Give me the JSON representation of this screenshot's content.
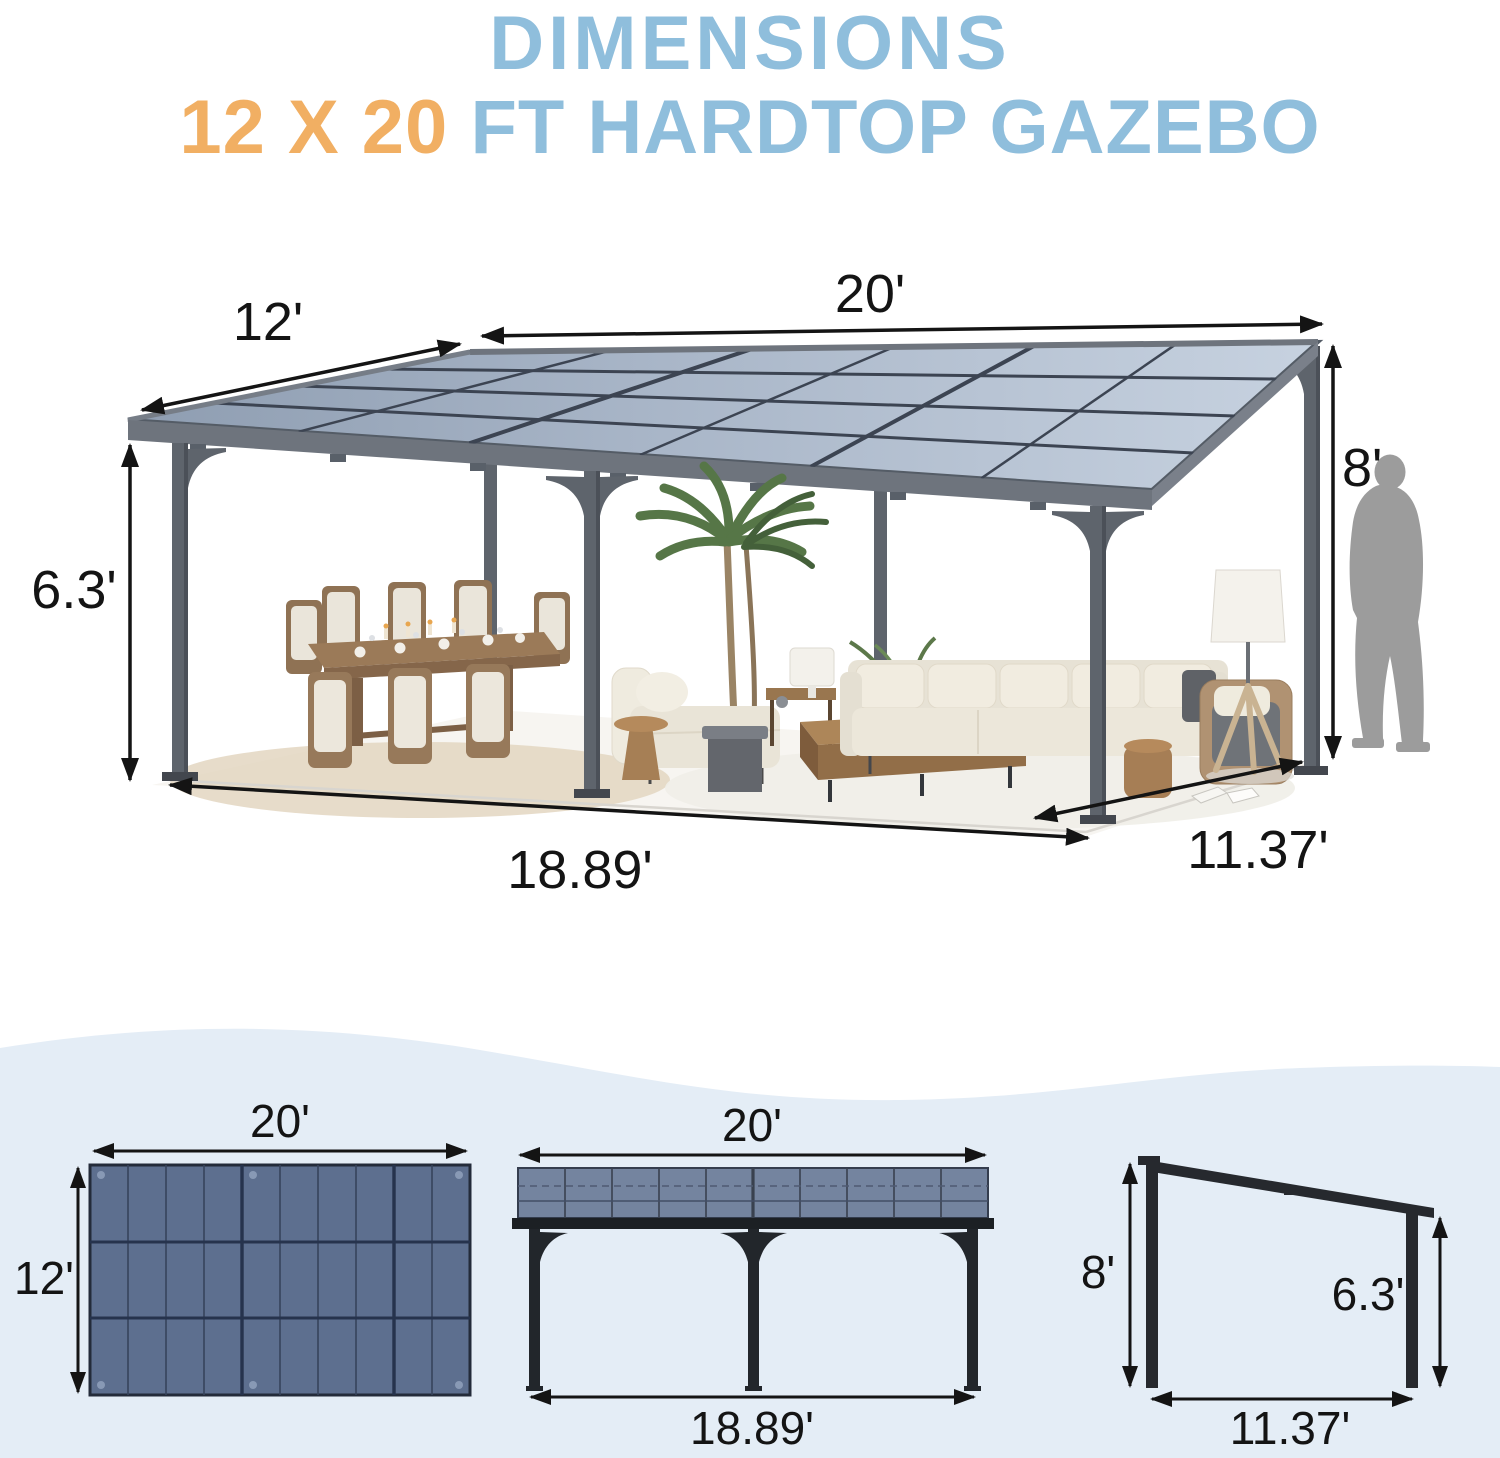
{
  "title": {
    "line1": "DIMENSIONS",
    "size_highlight": "12 X 20",
    "line2_rest": " FT HARDTOP GAZEBO"
  },
  "colors": {
    "title_blue": "#8FBEDC",
    "title_orange": "#F1AF63",
    "band_background": "#E4EDF6",
    "roof_slate": "#5D6F8F",
    "front_panel_slate": "#74849F",
    "frame_dark": "#26292E",
    "dimension_ink": "#141414"
  },
  "perspective_view": {
    "labels": {
      "roof_length": "20'",
      "roof_depth": "12'",
      "eave_height": "6.3'",
      "peak_height": "8'",
      "post_span_length": "18.89'",
      "post_span_depth": "11.37'"
    }
  },
  "top_view": {
    "length_label": "20'",
    "depth_label": "12'",
    "grid": {
      "columns": 10,
      "rows": 3
    }
  },
  "front_view": {
    "length_label": "20'",
    "post_span_label": "18.89'"
  },
  "side_view": {
    "peak_height_label": "8'",
    "eave_height_label": "6.3'",
    "depth_label": "11.37'"
  }
}
